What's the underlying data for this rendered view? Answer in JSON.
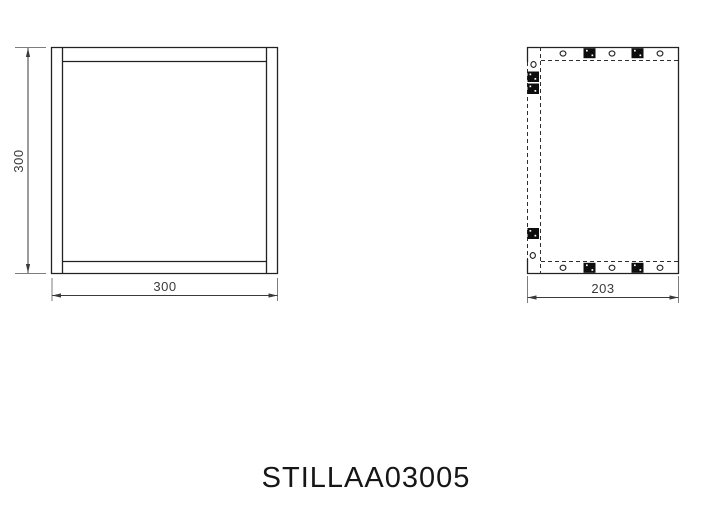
{
  "title_block": {
    "part_number": "STILLAA03005"
  },
  "dimensions": {
    "front_width": "300",
    "front_height": "300",
    "side_depth": "203"
  },
  "views": {
    "front": {
      "description": "front view of square frame"
    },
    "side": {
      "description": "side view with hidden lines and fittings"
    }
  },
  "colors": {
    "background": "#ffffff",
    "object_line": "#222222",
    "hidden_line": "#2e2e2e",
    "dimension_line": "#3a3a3a",
    "fitting_fill": "#0d0d0d",
    "text": "#333333",
    "title": "#161616"
  }
}
